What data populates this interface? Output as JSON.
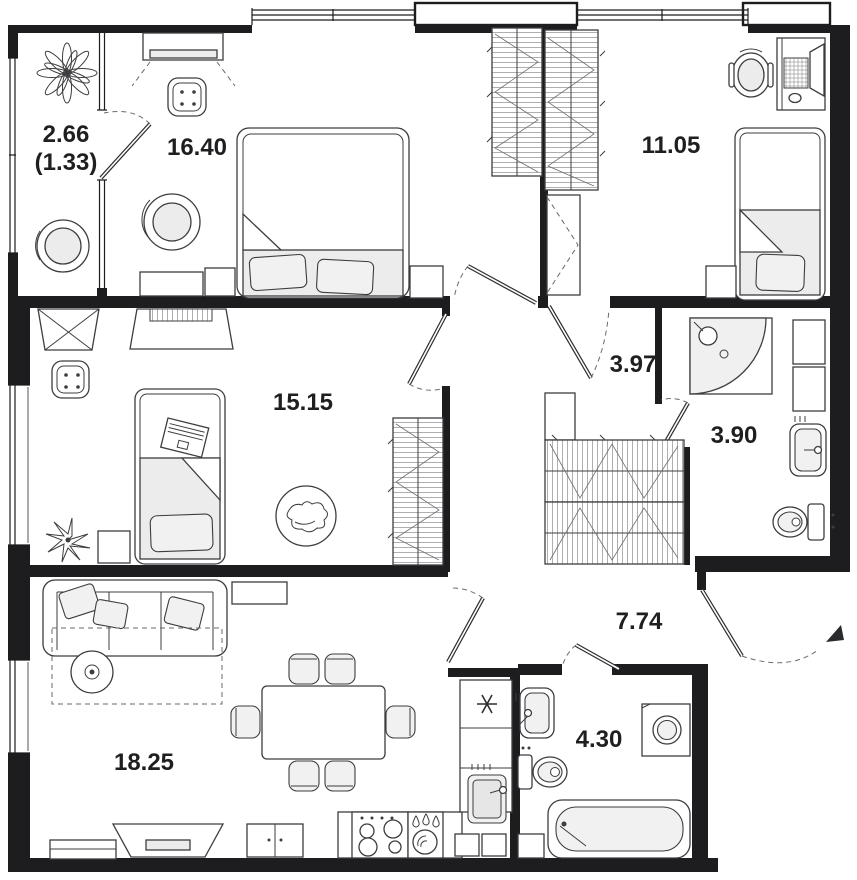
{
  "plan": {
    "type": "apartment-floor-plan",
    "rooms": {
      "balcony": {
        "area": "2.66",
        "area_coef": "(1.33)"
      },
      "bedroom": {
        "area": "16.40"
      },
      "bedroom2": {
        "area": "11.05"
      },
      "hall_top": {
        "area": "3.97"
      },
      "bath_top": {
        "area": "3.90"
      },
      "kids": {
        "area": "15.15"
      },
      "hall": {
        "area": "7.74"
      },
      "living": {
        "area": "18.25"
      },
      "bath": {
        "area": "4.30"
      }
    },
    "fixtures": [
      "double-bed",
      "single-bed",
      "wardrobe",
      "desk",
      "office-chair",
      "armchair",
      "pouf",
      "sofa",
      "coffee-table",
      "dining-table",
      "chairs",
      "tv-console",
      "kitchen-stove",
      "kitchen-sink",
      "fridge",
      "shower",
      "bathtub",
      "washing-machine",
      "toilet",
      "wash-basin",
      "plant",
      "pet-rug"
    ],
    "colors": {
      "wall": "#1d1d1f",
      "furniture_line": "#3d3d40",
      "soft_fill": "#ececec",
      "label": "#1f1f21",
      "background": "#ffffff"
    }
  }
}
